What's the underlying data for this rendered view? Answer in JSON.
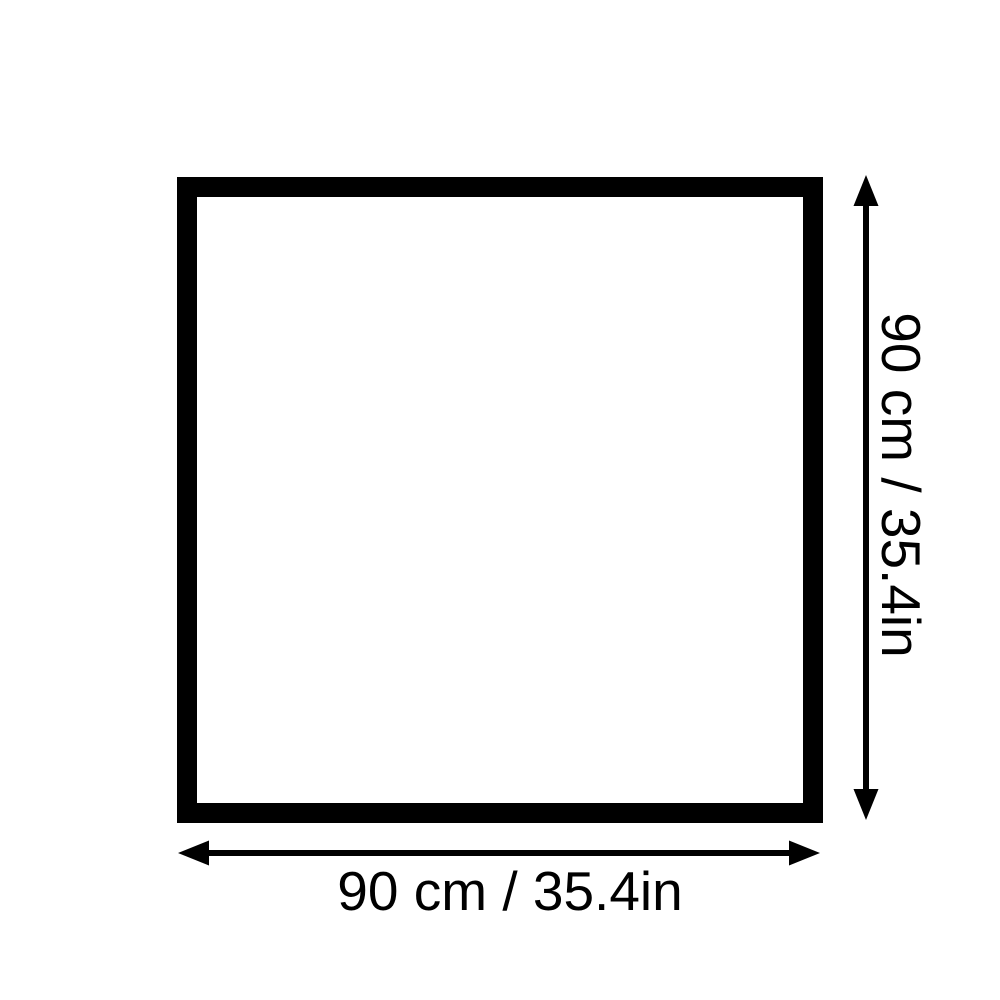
{
  "page": {
    "background_color": "#ffffff",
    "ink_color": "#000000"
  },
  "diagram": {
    "shape": {
      "type": "square-outline",
      "border_color": "#000000",
      "fill_color": "#ffffff"
    },
    "width_dimension": {
      "label": "90 cm / 35.4in",
      "arrow": "horizontal-double-headed-arrow"
    },
    "height_dimension": {
      "label": "90 cm / 35.4in",
      "arrow": "vertical-double-headed-arrow"
    }
  }
}
